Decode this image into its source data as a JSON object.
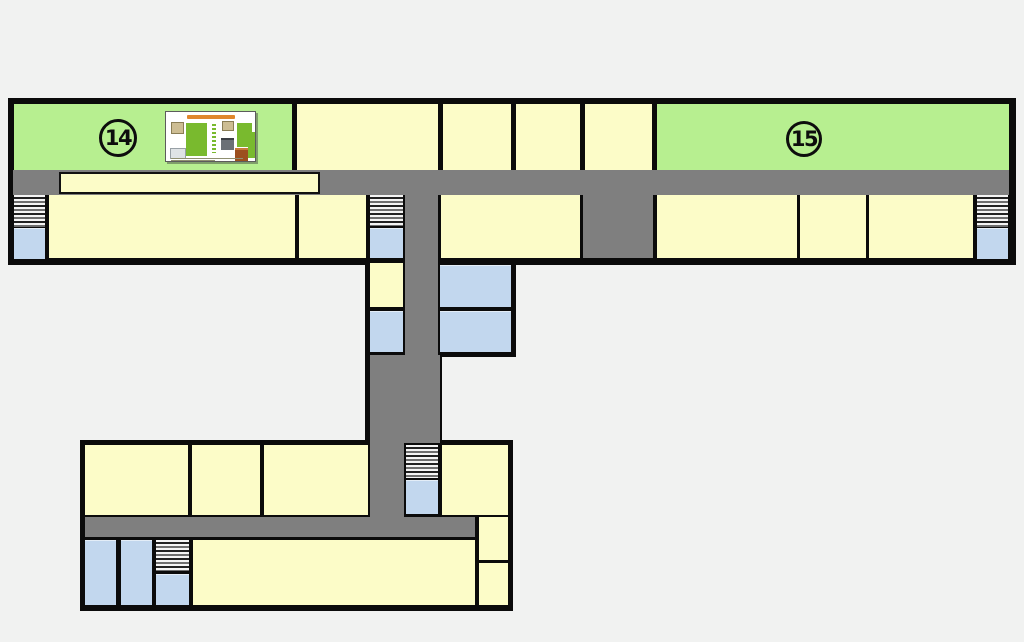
{
  "map": {
    "title": "Building floor plan (T-shaped corridor layout)",
    "room_labels": {
      "room14": "14",
      "room15": "15"
    },
    "palette": {
      "background": "#f1f2f1",
      "wall_black": "#0b0b0b",
      "corridor_gray": "#7f7f7f",
      "highlighted_room_green": "#b7ef90",
      "room_cream": "#fcfcc8",
      "elevator_blue": "#c2d7ee",
      "poster_green": "#79ba2e",
      "poster_title_orange": "#e0862c"
    },
    "features": {
      "highlighted_rooms": [
        "14",
        "15"
      ],
      "stairs_count": 5,
      "elevator_count": 5
    }
  }
}
